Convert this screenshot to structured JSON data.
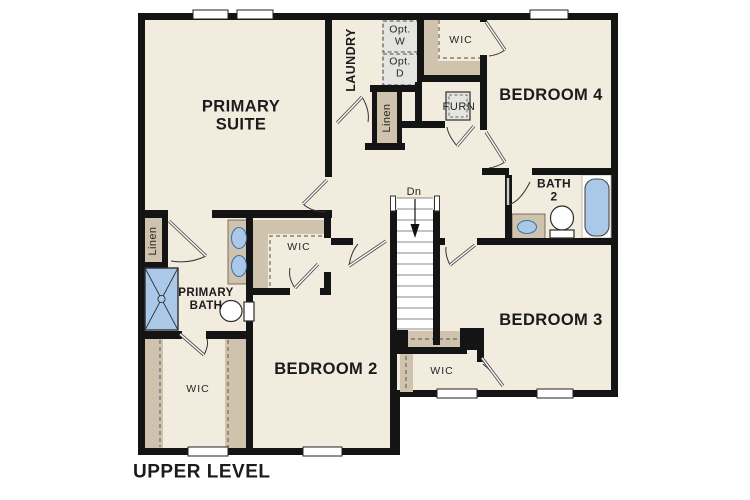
{
  "plan": {
    "level_label": "UPPER LEVEL"
  },
  "rooms": {
    "primary_suite": "PRIMARY\nSUITE",
    "laundry": "LAUNDRY",
    "bedroom_4": "BEDROOM 4",
    "bedroom_3": "BEDROOM 3",
    "bedroom_2": "BEDROOM 2",
    "bath_2": "BATH\n2",
    "primary_bath": "PRIMARY\nBATH"
  },
  "closets": {
    "wic_primary": "WIC",
    "wic_bedroom2": "WIC",
    "wic_bedroom3": "WIC",
    "wic_bedroom4": "WIC",
    "linen_hall": "Linen",
    "linen_bath": "Linen"
  },
  "utilities": {
    "furnace": "FURN",
    "opt_washer": "Opt.\nW",
    "opt_dryer": "Opt.\nD"
  },
  "stairs": {
    "direction_label": "Dn"
  },
  "colors": {
    "floor": "#f2ecdf",
    "wall": "#141414",
    "closet_tan": "#cfc3ad",
    "fixture_blue": "#aac9e8",
    "appliance_gray": "#e4e4e1"
  }
}
